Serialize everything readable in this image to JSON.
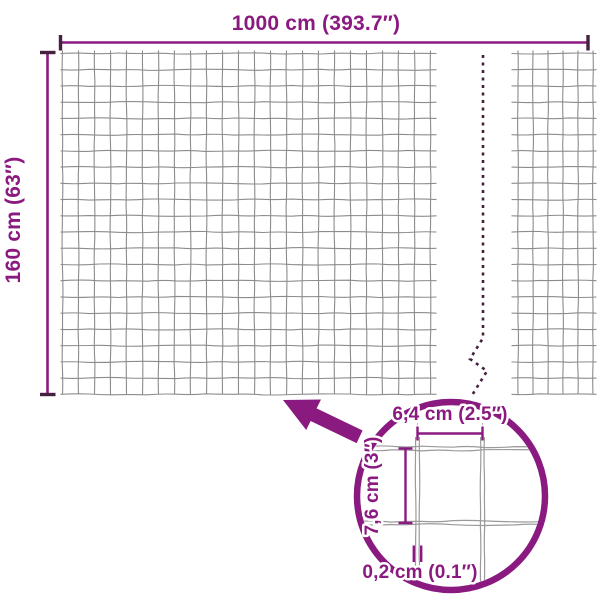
{
  "labels": {
    "total_width": "1000 cm (393.7″)",
    "total_height": "160 cm (63″)",
    "mesh_width": "6,4 cm (2.5″)",
    "mesh_height": "7,6 cm (3″)",
    "wire_thickness": "0,2 cm (0.1″)"
  },
  "colors": {
    "accent": "#8A1A80",
    "cap": "#46203F",
    "grid": "#8C8C8C",
    "detail_wire": "#9A9A9A",
    "dash": "#44203C",
    "background": "#FFFFFF"
  },
  "mesh": {
    "main_panel": {
      "rows": 22,
      "row_y0": 53.5,
      "row_spacing": 16.23,
      "h_x0": 60.5,
      "h_x1": 436.5,
      "cols": 24,
      "x0": 62.5,
      "col_spacing": 16.0,
      "col_y0": 50.5,
      "col_y1": 394.5,
      "seed": 1
    },
    "continuation_panel": {
      "rows": 22,
      "row_y0": 53.5,
      "row_spacing": 16.23,
      "h_x0": 511.5,
      "h_x1": 596.5,
      "cols": 6,
      "x0": 518,
      "col_spacing": 15.0,
      "col_y0": 50.5,
      "col_y1": 394.5,
      "seed": 60
    }
  }
}
